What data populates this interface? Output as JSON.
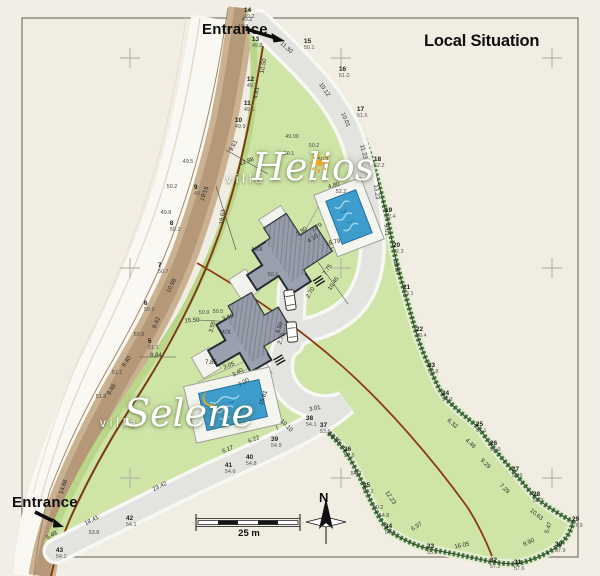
{
  "header": {
    "title": "Local Situation"
  },
  "entrances": {
    "top": "Entrance",
    "bottom": "Entrance"
  },
  "villas": {
    "helios": {
      "prefix": "villa",
      "name": "Helios",
      "icon": "sun-icon"
    },
    "selene": {
      "prefix": "villa",
      "name": "Selene",
      "icon": "moon-icon"
    }
  },
  "buildings": {
    "helios_label": "H/X",
    "selene_label": "H/X"
  },
  "scale_bar": {
    "label": "25 m"
  },
  "compass": {
    "label": "N"
  },
  "colors": {
    "paper": "#f2eee6",
    "lawn": "#cfe5a8",
    "hedge": "#4e7a44",
    "road": "#c9b191",
    "driveway": "#e3e3df",
    "boundary_red": "#8c3c12",
    "pool": "#3e9dcd",
    "building": "#9aa0ad",
    "accent_orange": "#f3a51d"
  },
  "map": {
    "survey_points": [
      [
        "5",
        "51.1",
        150,
        344
      ],
      [
        "6",
        "50.9",
        146,
        306
      ],
      [
        "7",
        "50.7",
        160,
        268
      ],
      [
        "8",
        "50.2",
        172,
        226
      ],
      [
        "9",
        "49.9",
        196,
        190
      ],
      [
        "10",
        "49.9",
        237,
        123
      ],
      [
        "11",
        "49.5",
        246,
        106
      ],
      [
        "12",
        "49.7",
        249,
        82
      ],
      [
        "13",
        "49.8",
        254,
        42
      ],
      [
        "14",
        "49.2",
        246,
        13
      ],
      [
        "15",
        "50.1",
        306,
        44
      ],
      [
        "16",
        "51.0",
        341,
        72
      ],
      [
        "17",
        "51.6",
        359,
        112
      ],
      [
        "18",
        "52.2",
        376,
        162
      ],
      [
        "19",
        "52.4",
        387,
        213
      ],
      [
        "20",
        "52.3",
        395,
        248
      ],
      [
        "21",
        "53.1",
        405,
        290
      ],
      [
        "22",
        "53.4",
        418,
        332
      ],
      [
        "23",
        "53.8",
        430,
        368
      ],
      [
        "24",
        "54.3",
        444,
        396
      ],
      [
        "25",
        "55.1",
        478,
        427
      ],
      [
        "26",
        "55.3",
        492,
        446
      ],
      [
        "27",
        "55.9",
        514,
        472
      ],
      [
        "28",
        "56.2",
        535,
        497
      ],
      [
        "29",
        "57.9",
        574,
        522
      ],
      [
        "30",
        "57.9",
        557,
        547
      ],
      [
        "31",
        "57.6",
        516,
        565
      ],
      [
        "32",
        "57.2",
        492,
        563
      ],
      [
        "33",
        "55.9",
        429,
        549
      ],
      [
        "34",
        "54.8",
        387,
        529
      ],
      [
        "35",
        "54.2",
        365,
        488
      ],
      [
        "36",
        "53.8",
        346,
        452
      ],
      [
        "37",
        "53.6",
        322,
        428
      ],
      [
        "38",
        "54.1",
        308,
        421
      ],
      [
        "39",
        "54.9",
        273,
        442
      ],
      [
        "40",
        "54.8",
        248,
        460
      ],
      [
        "41",
        "54.6",
        227,
        468
      ],
      [
        "42",
        "54.1",
        128,
        521
      ],
      [
        "43",
        "54.2",
        58,
        553
      ]
    ],
    "dimensions": [
      [
        "11.30",
        286,
        48,
        42
      ],
      [
        "10.12",
        324,
        90,
        55
      ],
      [
        "10.01",
        345,
        120,
        66
      ],
      [
        "11.23",
        363,
        152,
        75
      ],
      [
        "13.23",
        376,
        192,
        82
      ],
      [
        "9.01",
        386,
        230,
        84
      ],
      [
        "10.67",
        396,
        268,
        80
      ],
      [
        "12.23",
        390,
        498,
        56
      ],
      [
        "18.55",
        334,
        438,
        42
      ],
      [
        "10.10",
        286,
        426,
        46
      ],
      [
        "3.01",
        315,
        409,
        -12
      ],
      [
        "6.22",
        254,
        440,
        -22
      ],
      [
        "6.17",
        228,
        450,
        -22
      ],
      [
        "23.42",
        160,
        487,
        -27
      ],
      [
        "18.41",
        92,
        521,
        -27
      ],
      [
        "5.49",
        52,
        536,
        -30
      ],
      [
        "14.66",
        64,
        487,
        -72
      ],
      [
        "16.05",
        462,
        546,
        -12
      ],
      [
        "6.97",
        417,
        527,
        -33
      ],
      [
        "8.90",
        529,
        543,
        -24
      ],
      [
        "5.47",
        549,
        528,
        -70
      ],
      [
        "10.63",
        536,
        515,
        38
      ],
      [
        "7.29",
        504,
        489,
        45
      ],
      [
        "9.29",
        485,
        464,
        45
      ],
      [
        "4.48",
        470,
        444,
        42
      ],
      [
        "6.32",
        452,
        424,
        40
      ],
      [
        "9.61",
        234,
        146,
        -62
      ],
      [
        "19.15",
        205,
        194,
        -68
      ],
      [
        "11.98",
        247,
        162,
        -18
      ],
      [
        "19.63",
        223,
        217,
        -82
      ],
      [
        "15.50",
        192,
        321,
        -4
      ],
      [
        "8.84",
        156,
        356,
        0
      ],
      [
        "9.42",
        157,
        323,
        -68
      ],
      [
        "9.40",
        127,
        362,
        -55
      ],
      [
        "9.48",
        112,
        390,
        -58
      ],
      [
        "10.98",
        172,
        286,
        -64
      ],
      [
        "4.81",
        257,
        93,
        -80
      ],
      [
        "10.50",
        264,
        66,
        -80
      ],
      [
        "15.79",
        333,
        243,
        -12
      ],
      [
        "7.79",
        317,
        228,
        -34
      ],
      [
        "3.80",
        302,
        232,
        -34
      ],
      [
        "4.10",
        313,
        239,
        -34
      ],
      [
        "7.75",
        328,
        270,
        -56
      ],
      [
        "10.45",
        334,
        284,
        -56
      ],
      [
        "2.70",
        311,
        293,
        -58
      ],
      [
        "15.81",
        264,
        398,
        -72
      ],
      [
        "7.85",
        211,
        363,
        0
      ],
      [
        "3.05",
        229,
        366,
        -20
      ],
      [
        "3.40",
        238,
        373,
        -30
      ],
      [
        "7.00",
        244,
        383,
        -30
      ],
      [
        "3.55",
        213,
        327,
        -76
      ],
      [
        "3.85",
        228,
        318,
        -20
      ],
      [
        "4.50",
        280,
        328,
        -68
      ],
      [
        "2.70",
        282,
        339,
        -68
      ],
      [
        "4.80",
        334,
        186,
        -16
      ]
    ],
    "spot_heights": [
      [
        "49.00",
        292,
        137
      ],
      [
        "50.2",
        314,
        146
      ],
      [
        "50.1",
        289,
        154
      ],
      [
        "50.3",
        323,
        160
      ],
      [
        "49.5",
        188,
        162
      ],
      [
        "50.2",
        172,
        187
      ],
      [
        "49.8",
        166,
        213
      ],
      [
        "50.8",
        139,
        335
      ],
      [
        "51.1",
        117,
        373
      ],
      [
        "51.8",
        101,
        397
      ],
      [
        "49.2",
        247,
        20
      ],
      [
        "49.3",
        243,
        27
      ],
      [
        "50.9",
        204,
        313
      ],
      [
        "50.5",
        218,
        312
      ],
      [
        "50.1",
        273,
        275
      ],
      [
        "52.2",
        341,
        192
      ],
      [
        "54.2",
        356,
        474
      ],
      [
        "50.2",
        378,
        508
      ],
      [
        "54.8",
        384,
        516
      ],
      [
        "53.8",
        94,
        533
      ]
    ]
  }
}
